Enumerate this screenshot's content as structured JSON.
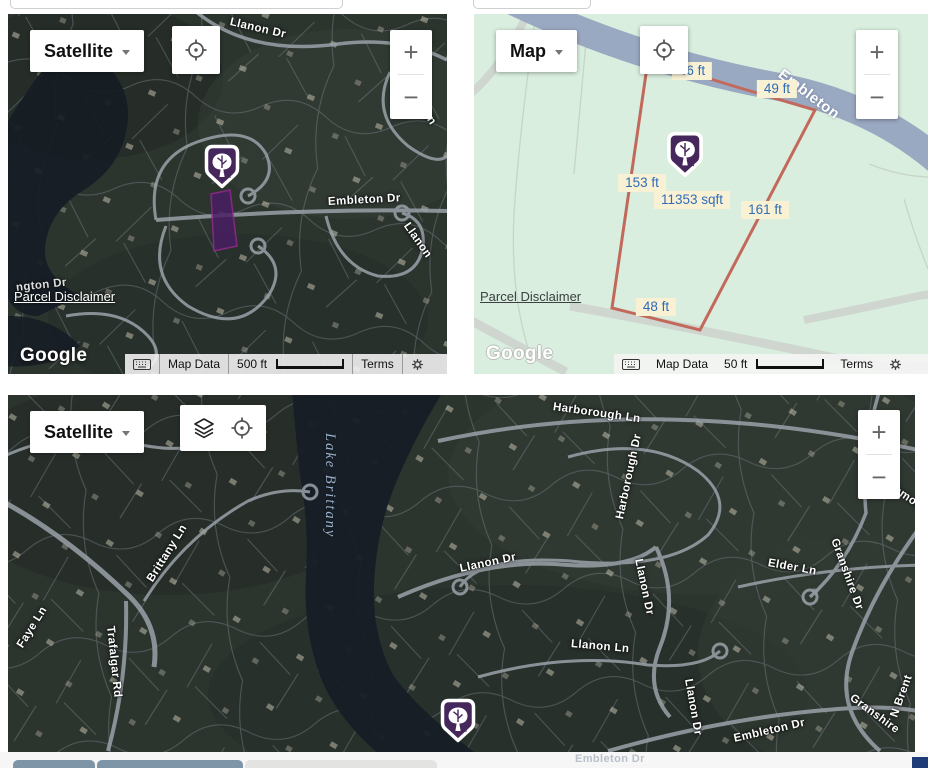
{
  "maps": {
    "top_left": {
      "map_type_button": "Satellite",
      "zoom_in_label": "+",
      "zoom_out_label": "−",
      "streets": {
        "llanon_dr_top": "Llanon Dr",
        "llanon_right_upper": "Llanon",
        "embleton_dr": "Embleton Dr",
        "llanon_right_lower": "Llanon",
        "ngton_dr_fragment": "ngton Dr"
      },
      "parcel_disclaimer_link": "Parcel Disclaimer",
      "google_logo": "Google",
      "attribution": {
        "map_data": "Map Data",
        "scale_label": "500 ft",
        "terms": "Terms"
      }
    },
    "top_right": {
      "map_type_button": "Map",
      "zoom_in_label": "+",
      "zoom_out_label": "−",
      "street_embleton": "Embleton",
      "measurements": {
        "top_edge": "46 ft",
        "top_right_edge": "49 ft",
        "left_edge": "153 ft",
        "lot_area": "11353 sqft",
        "right_edge": "161 ft",
        "bottom_edge": "48 ft"
      },
      "parcel_disclaimer_link": "Parcel Disclaimer",
      "google_logo": "Google",
      "attribution": {
        "map_data": "Map Data",
        "scale_label": "50 ft",
        "terms": "Terms"
      }
    },
    "bottom": {
      "map_type_button": "Satellite",
      "zoom_in_label": "+",
      "zoom_out_label": "−",
      "lake_label": "Lake Brittany",
      "streets": {
        "harborough_ln": "Harborough Ln",
        "harborough_dr": "Harborough Dr",
        "monmouth": "Monmouth",
        "llanon_dr_west": "Llanon Dr",
        "llanon_dr_center": "Llanon Dr",
        "elder_ln": "Elder Ln",
        "granshire_dr": "Granshire Dr",
        "llanon_ln": "Llanon Ln",
        "brittany_ln": "Brittany Ln",
        "faye_ln": "Faye Ln",
        "trafalgar_rd": "Trafalgar Rd",
        "llanon_dr_south": "Llanon Dr",
        "embleton_dr_south": "Embleton Dr",
        "granshire_south": "Granshire",
        "n_brent": "N Brent"
      },
      "ghost_label": "Embleton Dr"
    }
  },
  "colors": {
    "marker_purple": "#46275c",
    "lot_outline_red": "#c2695c",
    "parcel_map_bg": "#d9eede",
    "road_slate_blue": "#9aa9c2",
    "measurement_chip_bg": "#f9f1d4",
    "measurement_text_blue": "#2f6db8",
    "tab_slate": "#7e95a8",
    "tab_light_gray": "#e3e3e1",
    "corner_blue": "#1e3c78"
  }
}
